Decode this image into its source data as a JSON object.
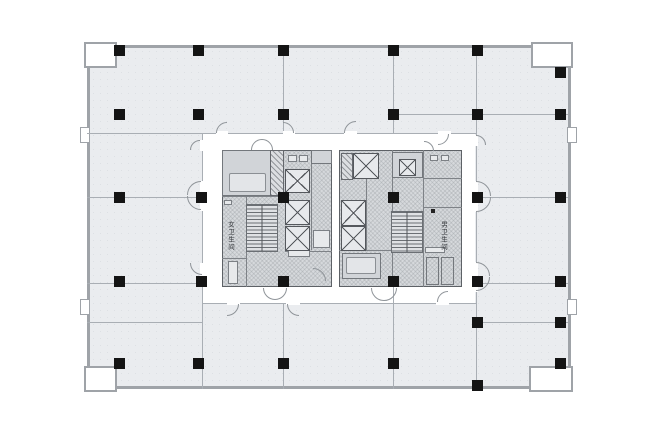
{
  "labels": {
    "women_restroom": "女卫生间",
    "men_restroom": "男卫生间"
  },
  "colors": {
    "floor_fill": "#eaecef",
    "outer_wall": "#9fa3a8",
    "partition": "#a9aeb4",
    "column": "#141414",
    "core_fill": "#d6d9dc",
    "core_wall": "#5d6166",
    "background": "#ffffff"
  },
  "plan": {
    "canvas": {
      "w": 660,
      "h": 440
    },
    "shell": {
      "x": 87,
      "y": 45,
      "w": 484,
      "h": 344
    },
    "core_zone": {
      "x": 202,
      "y": 134,
      "w": 273,
      "h": 169
    },
    "notches": [
      [
        84,
        42,
        33,
        26
      ],
      [
        531,
        42,
        42,
        26
      ],
      [
        84,
        366,
        33,
        26
      ],
      [
        529,
        366,
        44,
        26
      ]
    ],
    "tabs": [
      [
        80,
        127,
        10,
        16
      ],
      [
        80,
        299,
        10,
        16
      ],
      [
        567,
        127,
        10,
        16
      ],
      [
        567,
        299,
        10,
        16
      ]
    ],
    "partitions": {
      "h": [
        [
          87,
          476,
          133
        ],
        [
          87,
          202,
          197
        ],
        [
          87,
          202,
          283
        ],
        [
          87,
          202,
          322
        ],
        [
          393,
          568,
          114
        ],
        [
          476,
          568,
          197
        ],
        [
          476,
          568,
          283
        ],
        [
          476,
          568,
          322
        ],
        [
          202,
          476,
          303
        ]
      ],
      "v": [
        [
          45,
          133,
          283
        ],
        [
          45,
          133,
          393
        ],
        [
          45,
          389,
          476
        ],
        [
          133,
          389,
          202
        ],
        [
          303,
          389,
          283
        ],
        [
          287,
          389,
          393
        ]
      ]
    },
    "columns": [
      [
        119,
        50
      ],
      [
        198,
        50
      ],
      [
        283,
        50
      ],
      [
        393,
        50
      ],
      [
        477,
        50
      ],
      [
        560,
        72
      ],
      [
        119,
        114
      ],
      [
        198,
        114
      ],
      [
        283,
        114
      ],
      [
        393,
        114
      ],
      [
        477,
        114
      ],
      [
        560,
        114
      ],
      [
        119,
        197
      ],
      [
        201,
        197
      ],
      [
        283,
        197
      ],
      [
        393,
        197
      ],
      [
        477,
        197
      ],
      [
        560,
        197
      ],
      [
        119,
        281
      ],
      [
        201,
        281
      ],
      [
        283,
        281
      ],
      [
        393,
        281
      ],
      [
        477,
        281
      ],
      [
        560,
        281
      ],
      [
        477,
        322
      ],
      [
        560,
        322
      ],
      [
        119,
        363
      ],
      [
        198,
        363
      ],
      [
        283,
        363
      ],
      [
        393,
        363
      ],
      [
        560,
        363
      ],
      [
        477,
        385
      ]
    ],
    "gaps": [
      [
        216,
        131,
        12,
        4
      ],
      [
        283,
        131,
        12,
        4
      ],
      [
        344,
        131,
        13,
        4
      ],
      [
        438,
        131,
        13,
        4
      ],
      [
        200,
        140,
        4,
        11
      ],
      [
        200,
        181,
        4,
        30
      ],
      [
        200,
        263,
        4,
        13
      ],
      [
        474,
        135,
        4,
        11
      ],
      [
        474,
        181,
        4,
        31
      ],
      [
        474,
        262,
        4,
        30
      ],
      [
        227,
        301,
        13,
        4
      ],
      [
        286,
        301,
        14,
        4
      ],
      [
        436,
        301,
        13,
        4
      ]
    ],
    "doors": [
      [
        "tl",
        216,
        122,
        11
      ],
      [
        "tr",
        283,
        122,
        11
      ],
      [
        "tl",
        344,
        121,
        12
      ],
      [
        "br",
        438,
        134,
        11
      ],
      [
        "tl",
        190,
        140,
        10
      ],
      [
        "tl",
        187,
        181,
        14
      ],
      [
        "bl",
        187,
        196,
        14
      ],
      [
        "bl",
        190,
        263,
        12
      ],
      [
        "tr",
        476,
        135,
        10
      ],
      [
        "tr",
        476,
        181,
        15
      ],
      [
        "br",
        476,
        197,
        15
      ],
      [
        "tr",
        476,
        262,
        14
      ],
      [
        "br",
        476,
        277,
        14
      ],
      [
        "br",
        227,
        304,
        12
      ],
      [
        "bl",
        287,
        304,
        12
      ],
      [
        "tl",
        437,
        291,
        11
      ],
      [
        "tl",
        251,
        139,
        11
      ],
      [
        "tr",
        262,
        139,
        11
      ],
      [
        "bl",
        263,
        288,
        12
      ],
      [
        "br",
        275,
        288,
        12
      ],
      [
        "tr",
        313,
        268,
        13
      ],
      [
        "bl",
        371,
        288,
        13
      ],
      [
        "br",
        384,
        288,
        13
      ],
      [
        "tr",
        424,
        141,
        10
      ]
    ],
    "blocks": [
      {
        "rect": [
          222,
          150,
          110,
          137
        ],
        "rects": [
          [
            "room",
            222,
            150,
            50,
            46
          ],
          [
            "table",
            229,
            173,
            37,
            19
          ],
          [
            "shaft",
            270,
            150,
            14,
            46
          ],
          [
            "fixture",
            288,
            155,
            9,
            7
          ],
          [
            "fixture",
            299,
            155,
            9,
            7
          ],
          [
            "room",
            311,
            150,
            21,
            14
          ],
          [
            "fixture",
            313,
            230,
            17,
            18
          ],
          [
            "fixture",
            288,
            250,
            22,
            7
          ],
          [
            "fixture",
            228,
            261,
            10,
            23
          ],
          [
            "fixture",
            224,
            200,
            8,
            5
          ]
        ],
        "elevators": [
          [
            285,
            169,
            25,
            24
          ],
          [
            285,
            200,
            25,
            25
          ],
          [
            285,
            226,
            25,
            25
          ]
        ],
        "stairs": [
          [
            246,
            204,
            32,
            48
          ]
        ],
        "v": [
          [
            196,
            287,
            246
          ],
          [
            150,
            250,
            311
          ]
        ],
        "h": [
          [
            222,
            285,
            196
          ],
          [
            285,
            332,
            251
          ],
          [
            222,
            246,
            258
          ]
        ]
      },
      {
        "rect": [
          339,
          150,
          123,
          137
        ],
        "rects": [
          [
            "shaft",
            341,
            153,
            12,
            27
          ],
          [
            "fixture",
            430,
            155,
            8,
            6
          ],
          [
            "fixture",
            441,
            155,
            8,
            6
          ],
          [
            "room",
            392,
            152,
            31,
            26
          ],
          [
            "room",
            342,
            253,
            39,
            26
          ],
          [
            "table",
            346,
            257,
            30,
            17
          ],
          [
            "fixture",
            425,
            247,
            20,
            6
          ],
          [
            "stall",
            426,
            257,
            13,
            28
          ],
          [
            "stall",
            441,
            257,
            13,
            28
          ],
          [
            "dot",
            431,
            209,
            4,
            4
          ]
        ],
        "elevators": [
          [
            353,
            153,
            26,
            26
          ],
          [
            399,
            159,
            17,
            17
          ],
          [
            341,
            200,
            25,
            26
          ],
          [
            341,
            226,
            25,
            25
          ]
        ],
        "stairs": [
          [
            391,
            211,
            32,
            42
          ]
        ],
        "v": [
          [
            150,
            287,
            423
          ],
          [
            153,
            250,
            366
          ],
          [
            150,
            287,
            392
          ]
        ],
        "h": [
          [
            339,
            423,
            250
          ],
          [
            423,
            462,
            178
          ],
          [
            423,
            462,
            207
          ]
        ]
      }
    ]
  }
}
